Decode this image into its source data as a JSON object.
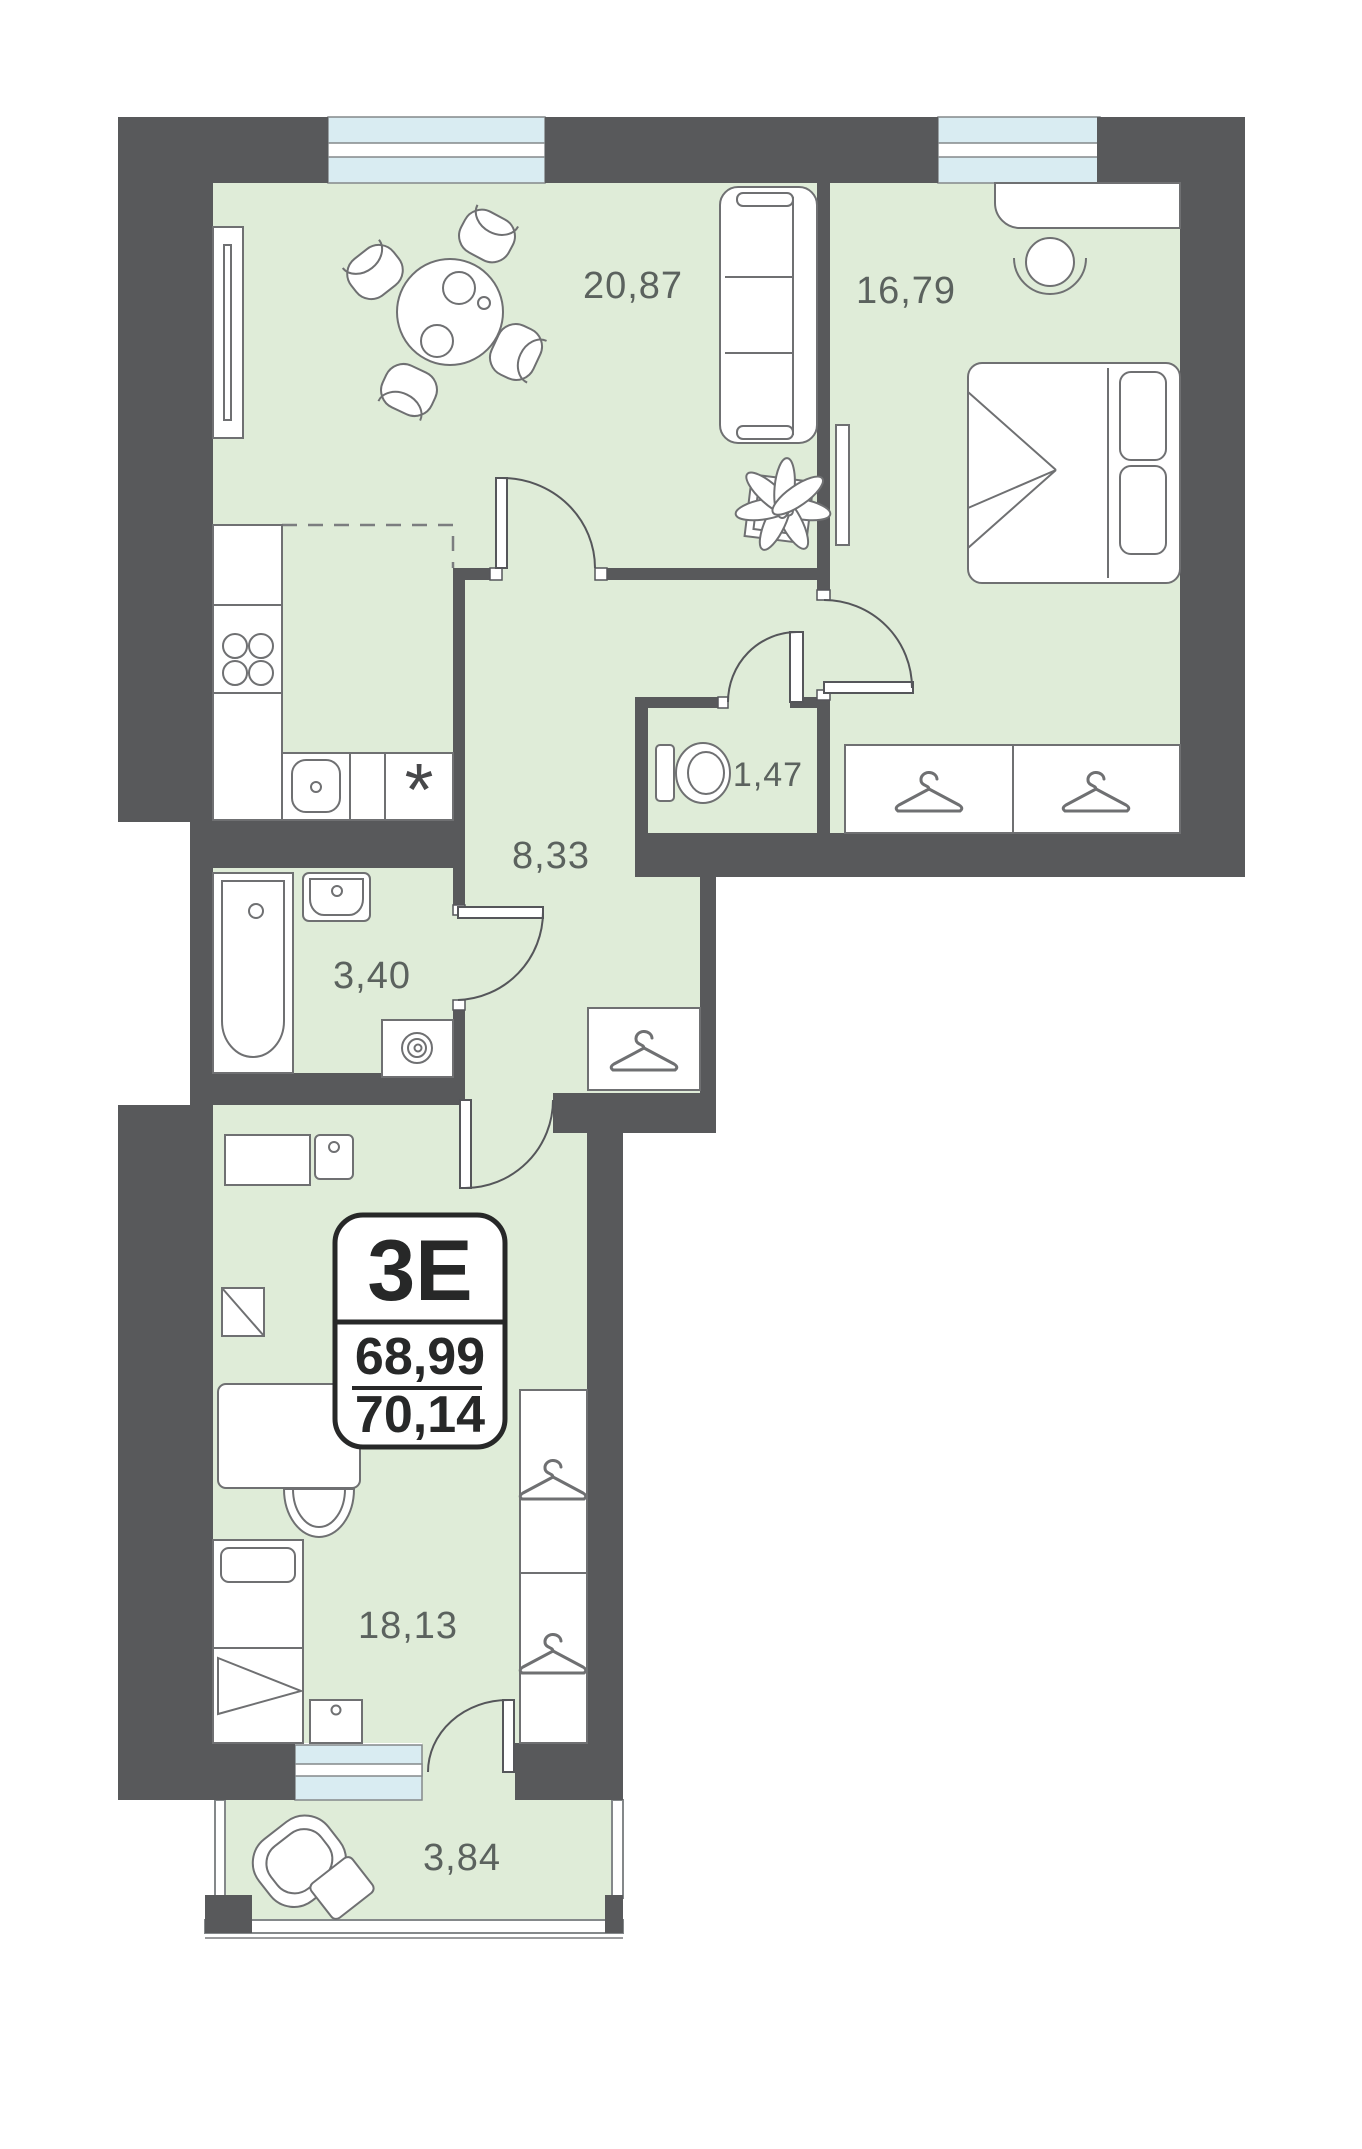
{
  "plan": {
    "unit_badge": {
      "type": "3E",
      "area_upper": "68,99",
      "area_lower": "70,14"
    },
    "rooms": {
      "living": {
        "area": "20,87"
      },
      "bedroom": {
        "area": "16,79"
      },
      "wc": {
        "area": "1,47"
      },
      "hallway": {
        "area": "8,33"
      },
      "bathroom": {
        "area": "3,40"
      },
      "bedroom2": {
        "area": "18,13"
      },
      "balcony": {
        "area": "3,84"
      }
    },
    "kitchen_symbol": "*",
    "colors": {
      "wall": "#58595b",
      "floor": "#dfecd8",
      "window": "#d9ecf2",
      "label": "#5b625e",
      "badge": "#272828"
    }
  }
}
